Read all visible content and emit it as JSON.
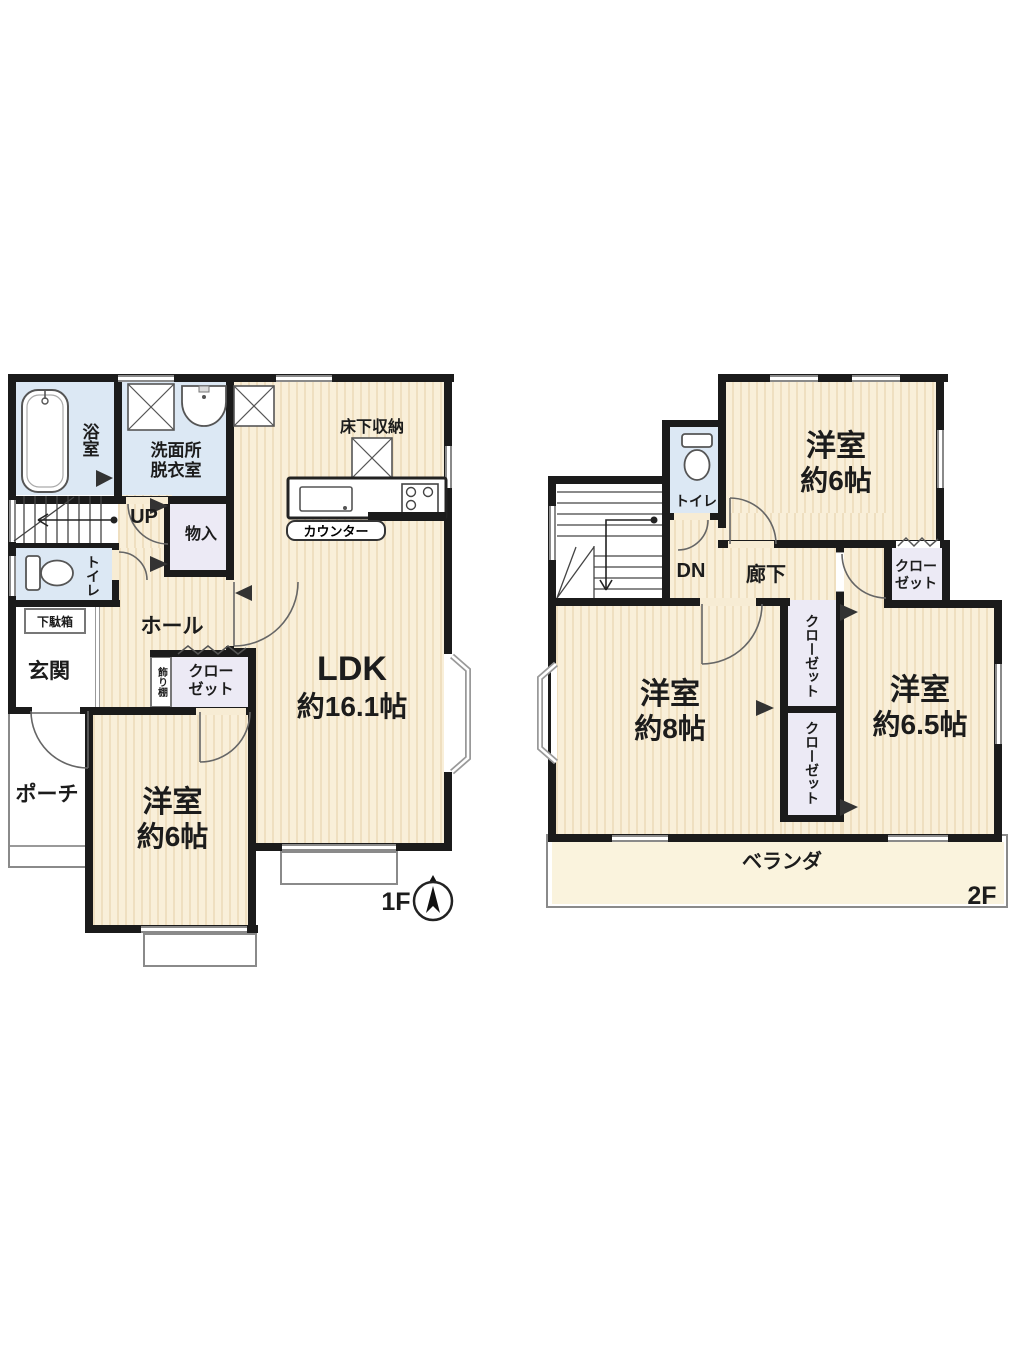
{
  "floor1": {
    "floor_label": "1F",
    "bath": "浴室",
    "washroom": [
      "洗面所",
      "脱衣室"
    ],
    "underfloor_storage": "床下収納",
    "counter": "カウンター",
    "ldk": [
      "LDK",
      "約16.1帖"
    ],
    "up": "UP",
    "storage": "物入",
    "toilet": "トイレ",
    "shoe_cabinet": "下駄箱",
    "entrance": "玄関",
    "hall": "ホール",
    "porch": "ポーチ",
    "display_shelf": "飾り棚",
    "closet": [
      "クロー",
      "ゼット"
    ],
    "bedroom6": [
      "洋室",
      "約6帖"
    ]
  },
  "floor2": {
    "floor_label": "2F",
    "down": "DN",
    "toilet": "トイレ",
    "corridor": "廊下",
    "bedroom6": [
      "洋室",
      "約6帖"
    ],
    "bedroom8": [
      "洋室",
      "約8帖"
    ],
    "bedroom65": [
      "洋室",
      "約6.5帖"
    ],
    "closet_right": [
      "クロー",
      "ゼット"
    ],
    "closet_upper": [
      "クロー",
      "ゼット"
    ],
    "closet_lower": [
      "クロー",
      "ゼット"
    ],
    "veranda": "ベランダ"
  },
  "colors": {
    "wall": "#1b1b1b",
    "floor": "#f8edd3",
    "floor_stripe": "#efdfc0",
    "wet_area": "#dce8f4",
    "closet": "#eceaf5",
    "veranda": "#faf3dd"
  }
}
